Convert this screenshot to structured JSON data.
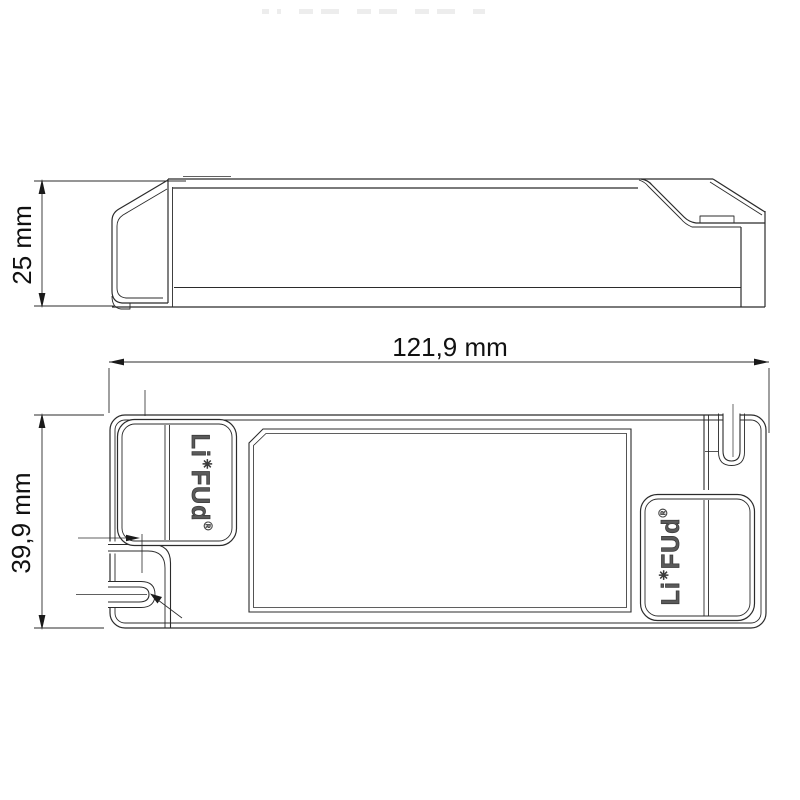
{
  "drawing": {
    "side_view": {
      "height_dimension_label": "25 mm"
    },
    "plan_view": {
      "width_dimension_label": "121,9 mm",
      "height_dimension_label": "39,9 mm"
    },
    "brand": {
      "prefix": "Li",
      "flower_mark": "✳",
      "suffix": "FUd",
      "registered_mark": "®"
    },
    "colors": {
      "line": "#2b2b2b",
      "background": "#ffffff"
    }
  }
}
